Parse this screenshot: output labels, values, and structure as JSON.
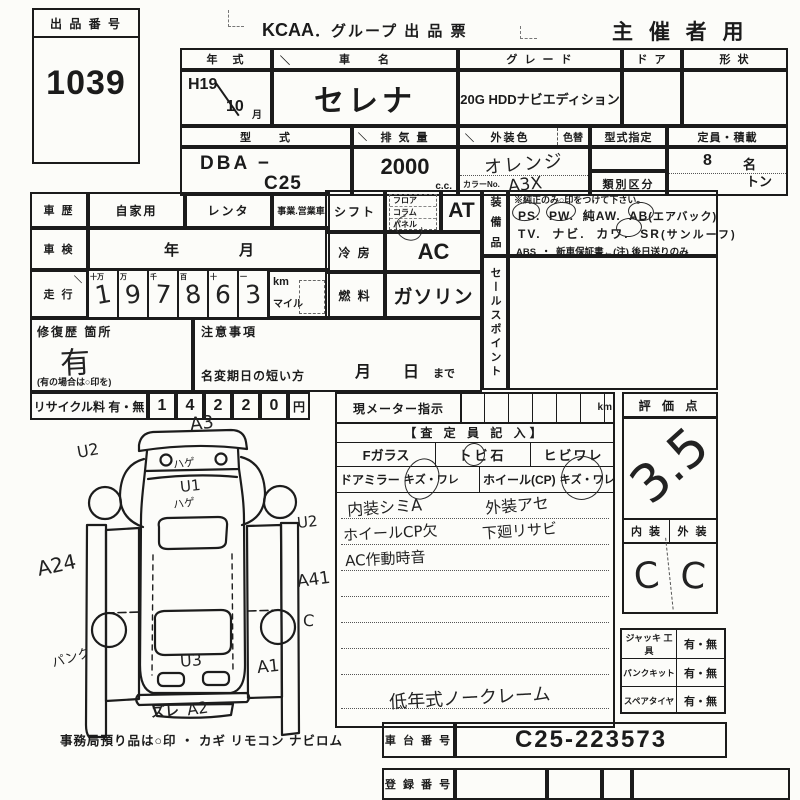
{
  "header": {
    "brand": "KCAA",
    "title": "．グループ 出 品 票",
    "organizer": "主 催 者 用"
  },
  "lot": {
    "label": "出 品 番 号",
    "number": "1039"
  },
  "marks": {
    "diag": "＼"
  },
  "vehicle": {
    "year_label": "年　式",
    "year": "H19",
    "month": "10",
    "month_label": "月",
    "name_label": "車　　名",
    "name": "セレナ",
    "grade_label": "グ レ ー ド",
    "grade": "20G HDDナビエディション",
    "door_label": "ド ア",
    "shape_label": "形 状",
    "model_label": "型　　式",
    "model_prefix": "DBA −",
    "model": "C25",
    "displacement_label": "排 気 量",
    "displacement": "2000",
    "displacement_unit": "c.c.",
    "color_label": "外装色",
    "color_change_label": "色替",
    "color": "オレンジ",
    "color_no_label": "カラーNo.",
    "color_no": "A3X",
    "type_designation_label": "型式指定",
    "class_label": "類別区分",
    "capacity_label": "定員・積載",
    "capacity": "8",
    "capacity_unit": "名",
    "ton": "トン"
  },
  "history": {
    "label": "車 歴",
    "private": "自家用",
    "rental": "レンタ",
    "business": "事業.営業車"
  },
  "inspection": {
    "label": "車 検",
    "value": "年　　　　月"
  },
  "odometer": {
    "label": "走 行",
    "digit_headers": [
      "十万",
      "万",
      "千",
      "百",
      "十",
      "一"
    ],
    "digits": [
      "1",
      "9",
      "7",
      "8",
      "6",
      "3"
    ],
    "unit_km": "km",
    "unit_mile": "マイル"
  },
  "shift": {
    "label": "シフト",
    "opt1": "フロア",
    "opt2": "コラム",
    "opt3": "パネル",
    "value": "AT"
  },
  "ac": {
    "label": "冷 房",
    "value": "AC"
  },
  "fuel": {
    "label": "燃 料",
    "value": "ガソリン"
  },
  "equipment": {
    "label": "装 備 品",
    "note": "※純正のみ○印をつけて下さい。",
    "ps": "PS.",
    "pw": "PW.",
    "aw": "純AW.",
    "ab": "AB",
    "ab_paren": "(エアバック)",
    "tv": "TV.",
    "navi": "ナビ.",
    "kawa": "カワ.",
    "sr": "SR",
    "sr_paren": "(サンルーフ)",
    "abs": "ABS",
    "dot": "・",
    "warranty": "新車保証書←(注) 後日送りのみ"
  },
  "sales": {
    "label": "セールスポイント"
  },
  "repair": {
    "label": "修復歴 箇所",
    "value": "有",
    "note": "(有の場合は○印を)"
  },
  "caution": {
    "label": "注意事項",
    "transfer": "名変期日の短い方",
    "due": "月　　日",
    "made": "まで"
  },
  "recycle": {
    "label": "リサイクル料 有・無",
    "digits": [
      "1",
      "4",
      "2",
      "2",
      "0"
    ],
    "unit": "円"
  },
  "meter": {
    "label": "現メーター指示",
    "unit": "km"
  },
  "inspector": {
    "header": "【査 定 員 記 入】",
    "fglass": "Fガラス",
    "tobi": "トビ石",
    "hibi": "ヒビワレ",
    "mirror": "ドアミラー",
    "mirror_kizu": "キズ・ワレ",
    "wheel": "ホイール(CP)",
    "wheel_kizu": "キズ・ワレ",
    "note1a": "内装シミA",
    "note1b": "外装アセ",
    "note2a": "ホイールCP欠",
    "note2b": "下廻リサビ",
    "note3a": "AC作動時音",
    "bottom_note": "低年式ノークレーム"
  },
  "score": {
    "label": "評 価 点",
    "value": "3.5",
    "interior_label": "内 装",
    "exterior_label": "外 装",
    "interior": "C",
    "exterior": "C"
  },
  "tools": [
    {
      "label": "ジャッキ 工具",
      "value": "有・無"
    },
    {
      "label": "パンクキット",
      "value": "有・無"
    },
    {
      "label": "スペアタイヤ",
      "value": "有・無"
    }
  ],
  "chassis": {
    "label": "車 台 番 号",
    "value": "C25-223573"
  },
  "registration": {
    "label": "登 録 番 号"
  },
  "footer": {
    "text": "事務局預り品は○印 ・ カギ リモコン ナビロム"
  },
  "diagram": {
    "annotations": {
      "a3": "A3",
      "u2_top": "U2",
      "hage_top": "ハゲ",
      "u1": "U1",
      "hage_mid": "ハゲ",
      "u2_right": "U2",
      "a24": "A24",
      "a41": "A41",
      "c": "C",
      "panku": "パンク",
      "u3": "U3",
      "a1": "A1",
      "zure": "ズレ",
      "a2": "A2"
    }
  }
}
